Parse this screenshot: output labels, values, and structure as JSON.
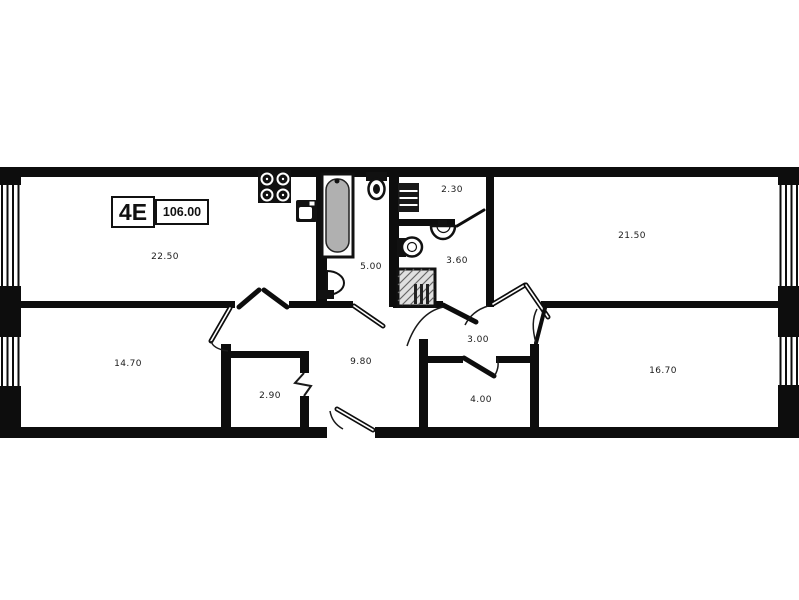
{
  "unit": {
    "type_label": "4E",
    "total_area": "106.00"
  },
  "rooms": [
    {
      "name": "living-kitchen",
      "area": "22.50"
    },
    {
      "name": "bathroom",
      "area": "5.00"
    },
    {
      "name": "storage",
      "area": "2.30"
    },
    {
      "name": "shower-wc",
      "area": "3.60"
    },
    {
      "name": "bedroom-top-right",
      "area": "21.50"
    },
    {
      "name": "bedroom-bottom-left",
      "area": "14.70"
    },
    {
      "name": "wardrobe",
      "area": "2.90"
    },
    {
      "name": "hallway",
      "area": "9.80"
    },
    {
      "name": "vestibule",
      "area": "3.00"
    },
    {
      "name": "closet",
      "area": "4.00"
    },
    {
      "name": "bedroom-bottom-right",
      "area": "16.70"
    }
  ],
  "fixtures": [
    "stove-icon",
    "kitchen-sink-icon",
    "bathtub-icon",
    "toilet-icon",
    "washbasin-icon",
    "shelving-icon",
    "wc-sink-icon",
    "wc-toilet-icon",
    "shower-icon",
    "window-icon",
    "door-swing-icon",
    "entrance-door-icon"
  ],
  "colors": {
    "wall": "#0d0d0d",
    "background": "#ffffff",
    "fixture_gray": "#b0b0b0"
  }
}
